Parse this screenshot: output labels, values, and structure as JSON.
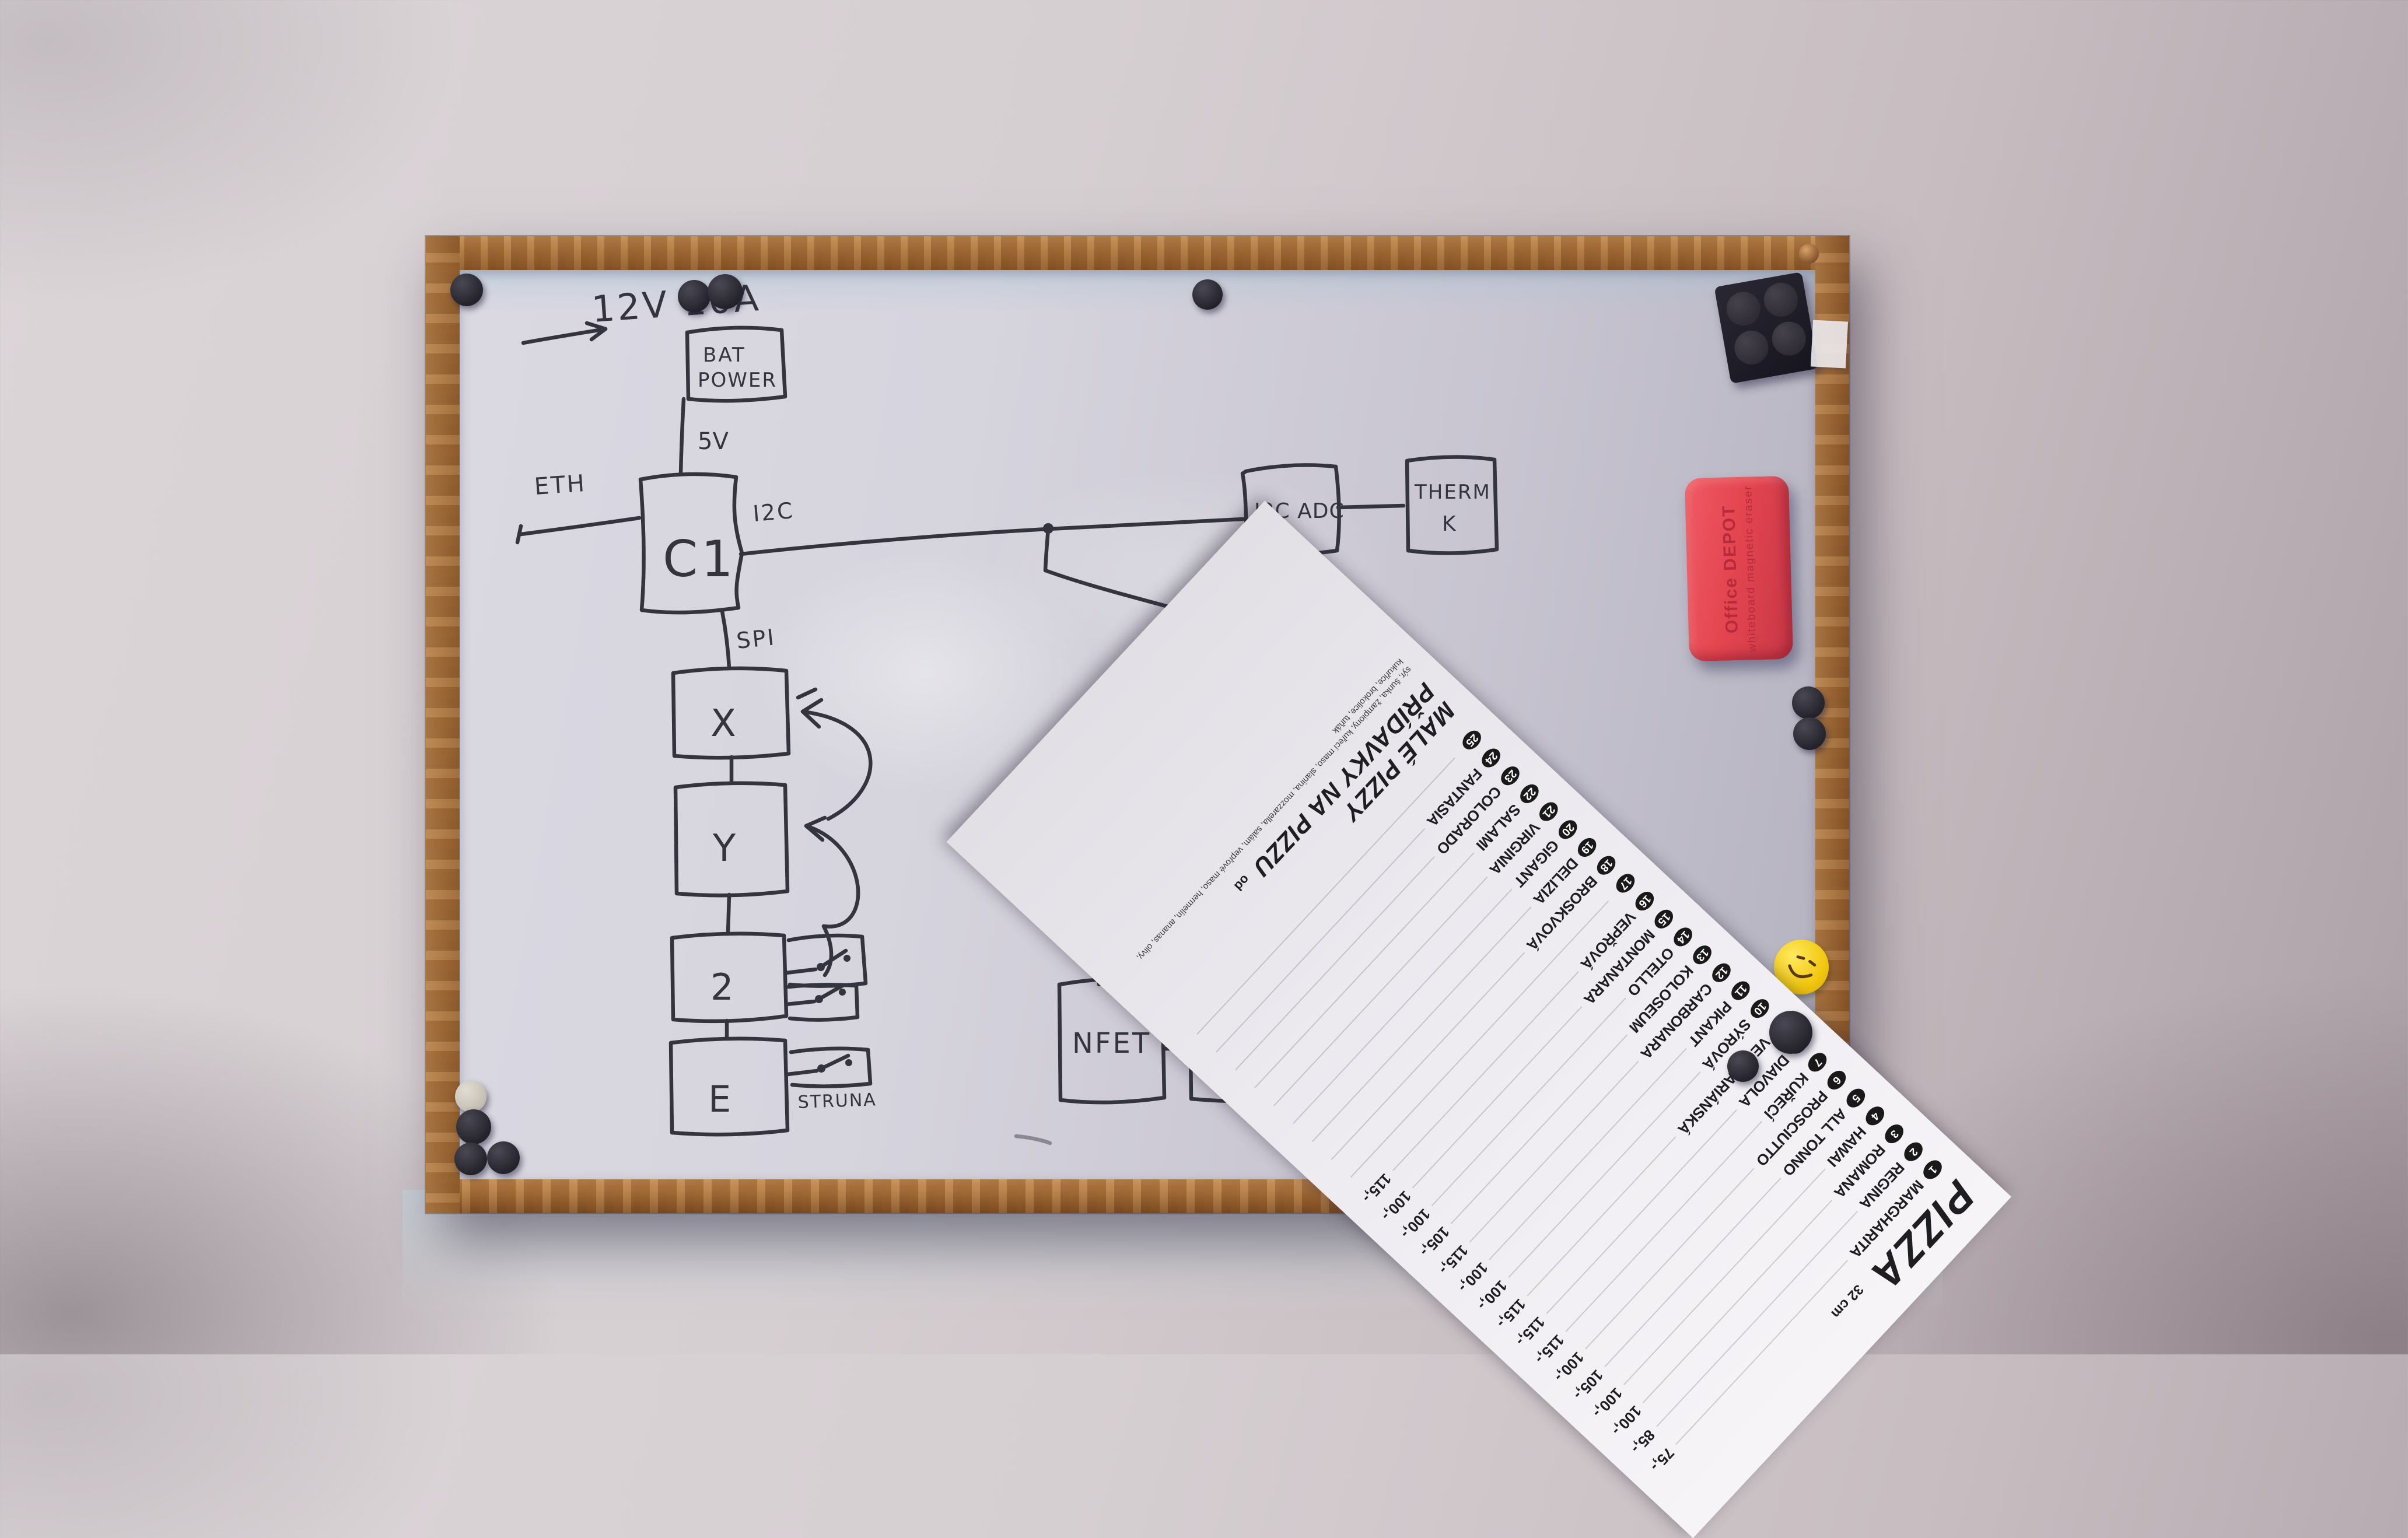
{
  "board": {
    "labels": {
      "supply": "12V 10A",
      "v5": "5V",
      "eth": "ETH",
      "i2c": "I2C",
      "spi": "SPI",
      "v12": "12V",
      "extruder": "EXRUDER",
      "struna": "STRUNA"
    },
    "boxes": {
      "bat": {
        "line1": "BAT",
        "line2": "POWER"
      },
      "c1": "C1",
      "x": "X",
      "y": "Y",
      "z": "2",
      "e": "E",
      "nfet": "NFET",
      "i2c_pwm": "I2C PWM",
      "i2c_adc": "I2C ADC",
      "therm": {
        "line1": "THERM",
        "line2": "K"
      }
    }
  },
  "eraser": {
    "brand": "Office DEPOT",
    "subtitle": "whiteboard magnetic eraser",
    "color": "#e4454f"
  },
  "menu": {
    "title": "PIZZA",
    "size_note": "32 cm",
    "items": [
      {
        "num": "1",
        "name": "MARGHARITA",
        "price": "75,-"
      },
      {
        "num": "2",
        "name": "REGINA",
        "price": "85,-"
      },
      {
        "num": "3",
        "name": "ROMANA",
        "price": "100,-"
      },
      {
        "num": "4",
        "name": "HAWAI",
        "price": "100,-"
      },
      {
        "num": "5",
        "name": "ALL TONNO",
        "price": "105,-"
      },
      {
        "num": "6",
        "name": "PROSCIUTTO",
        "price": "100,-"
      },
      {
        "num": "7",
        "name": "KUŘECÍ",
        "price": "115,-"
      },
      {
        "num": "8",
        "name": "DIAVOLA",
        "price": "115,-"
      },
      {
        "num": "9",
        "name": "VEGETARIÁNSKÁ",
        "price": "115,-"
      },
      {
        "num": "10",
        "name": "SÝROVÁ",
        "price": "100,-"
      },
      {
        "num": "11",
        "name": "PIKANT",
        "price": "100,-"
      },
      {
        "num": "12",
        "name": "CARBONARA",
        "price": "115,-"
      },
      {
        "num": "13",
        "name": "KOLOSEUM",
        "price": "105,-"
      },
      {
        "num": "14",
        "name": "OTELLO",
        "price": "100,-"
      },
      {
        "num": "15",
        "name": "MONTANARA",
        "price": "100,-"
      },
      {
        "num": "16",
        "name": "VEPŘOVÁ",
        "price": "115,-"
      }
    ],
    "items2": [
      {
        "num": "17",
        "name": "",
        "price": ""
      },
      {
        "num": "18",
        "name": "BROSKVOVÁ",
        "price": ""
      },
      {
        "num": "19",
        "name": "DELIZIA",
        "price": ""
      },
      {
        "num": "20",
        "name": "GIGANT",
        "price": ""
      },
      {
        "num": "21",
        "name": "VIRGINIA",
        "price": ""
      },
      {
        "num": "22",
        "name": "SALAMI",
        "price": ""
      },
      {
        "num": "23",
        "name": "COLORADO",
        "price": ""
      },
      {
        "num": "24",
        "name": "FANTASIA",
        "price": ""
      },
      {
        "num": "25",
        "name": "",
        "price": ""
      }
    ],
    "headings": {
      "small_pizzas": "MALÉ PIZZY",
      "addons": "PŘÍDAVKY NA PIZZU",
      "addons_note": "od"
    },
    "fine_print": "sýr, šunka, žampiony, kuřecí maso, slanina, mozzarella, salám, vepřové maso, hermelín, ananas, olivy, kukuřice, brokolice, tuňák"
  },
  "colors": {
    "marker": "#34343f",
    "frame_wood": "#a8713f",
    "eraser_red": "#e4454f",
    "smiley_yellow": "#f2c70f"
  }
}
